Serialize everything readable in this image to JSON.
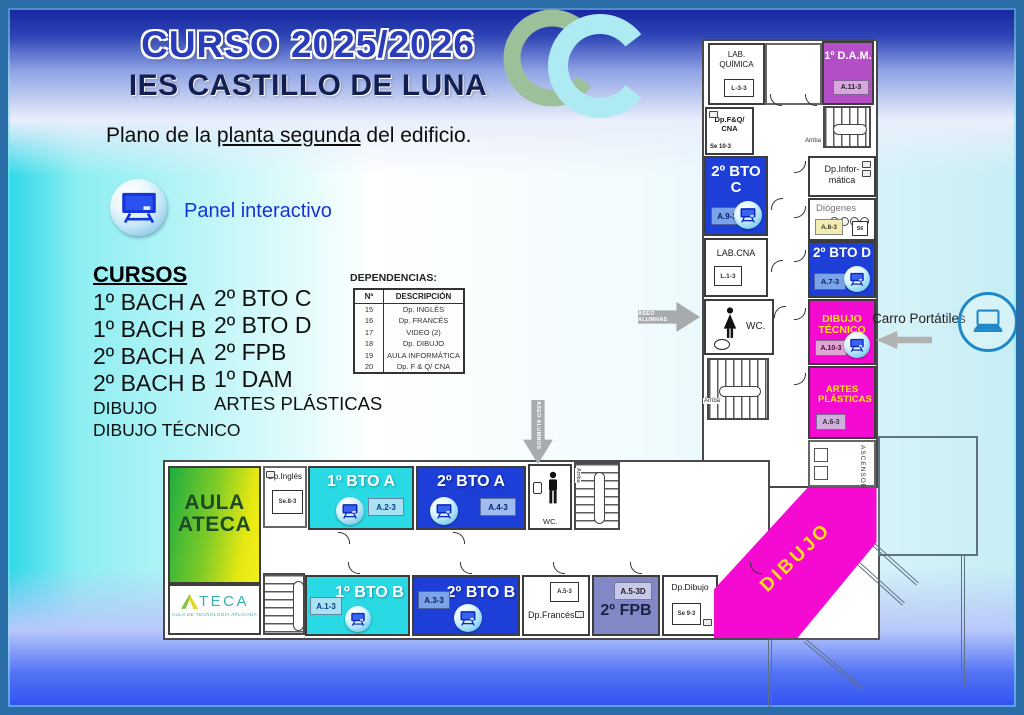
{
  "header": {
    "course_title": "CURSO 2025/2026",
    "school_name": "IES CASTILLO DE LUNA",
    "subtitle_prefix": "Plano de la ",
    "subtitle_underline": "planta segunda",
    "subtitle_suffix": " del edificio."
  },
  "legend": {
    "panel_label": "Panel interactivo"
  },
  "cursos": {
    "title": "CURSOS",
    "col1_large": [
      "1º BACH A",
      "1º BACH B",
      "2º BACH A",
      "2º BACH B"
    ],
    "col1_small": [
      "DIBUJO",
      "DIBUJO TÉCNICO"
    ],
    "col2_large": [
      "2º BTO C",
      "2º BTO D",
      "2º FPB",
      "1º DAM"
    ],
    "col2_small": [
      "ARTES PLÁSTICAS"
    ]
  },
  "dependencias": {
    "title": "DEPENDENCIAS:",
    "headers": [
      "Nº",
      "DESCRIPCIÓN"
    ],
    "rows": [
      [
        "15",
        "Dp. INGLÉS"
      ],
      [
        "16",
        "Dp. FRANCÉS"
      ],
      [
        "17",
        "VIDEO (2)"
      ],
      [
        "18",
        "Dp. DIBUJO"
      ],
      [
        "19",
        "AULA INFORMÁTICA"
      ],
      [
        "20",
        "Dp. F & Q/ CNA"
      ]
    ]
  },
  "plan": {
    "wc_label": "WC.",
    "arriba": "Arriba",
    "aseo_alumnas": "ASEO ALUMNAS",
    "aseo_alumnos": "ASEO ALUMNOS",
    "carro_portatiles": "Carro Portátiles",
    "rooms": {
      "lab_quimica": {
        "name": "LAB. QUÍMICA",
        "code": "L-3-3"
      },
      "dam": {
        "name": "1º D.A.M.",
        "code": "A.11-3"
      },
      "dp_fq_cna": {
        "name": "Dp.F&Q/ CNA",
        "code": "Se 10-3"
      },
      "bto2c": {
        "name": "2º BTO C",
        "code": "A.9-3"
      },
      "lab_cna": {
        "name": "LAB.CNA",
        "code": "L.1-3"
      },
      "dp_informatica": {
        "name": "Dp.Infor-mática"
      },
      "diogenes": {
        "name": "Diógenes",
        "code": "A.8-3",
        "code2": "S6"
      },
      "bto2d": {
        "name": "2º BTO D",
        "code": "A.7-3"
      },
      "dibujo_tecnico": {
        "name": "DIBUJO TÉCNICO",
        "code": "A.10-3"
      },
      "artes_plasticas": {
        "name": "ARTES PLÁSTICAS",
        "code": "A.6-3"
      },
      "ascensor": {
        "name": "ASCENSOR"
      },
      "aula_ateca": {
        "name": "AULA ATECA"
      },
      "dp_ingles": {
        "name": "Dp.Inglés",
        "code": "Se.8-3"
      },
      "bto1a": {
        "name": "1º BTO A",
        "code": "A.2-3"
      },
      "bto2a": {
        "name": "2º BTO A",
        "code": "A.4-3"
      },
      "bto1b": {
        "name": "1º BTO B",
        "code": "A.1-3"
      },
      "bto2b": {
        "name": "2º BTO B",
        "code": "A.3-3"
      },
      "dp_frances": {
        "name": "Dp.Francés",
        "code": "A.5-3"
      },
      "fpb": {
        "name": "2º FPB",
        "code": "A.5-3D"
      },
      "dp_dibujo": {
        "name": "Dp.Dibujo",
        "code": "Se 9-3"
      },
      "dibujo": {
        "name": "DIBUJO"
      }
    }
  },
  "ateca": {
    "brand": "TECA",
    "tagline": "AULA DE TECNOLOGÍA APLICADA"
  },
  "colors": {
    "room_blue": "#1d3fd8",
    "room_cyan": "#29d9e4",
    "room_magenta": "#f50ad2",
    "room_purple": "#b44fc8",
    "room_slate": "#8287c6",
    "label_yellow": "#ffe116",
    "ateca_green": "#1fae3f",
    "ateca_yellow": "#f0ef1a",
    "frame_blue": "#2a6da7"
  }
}
